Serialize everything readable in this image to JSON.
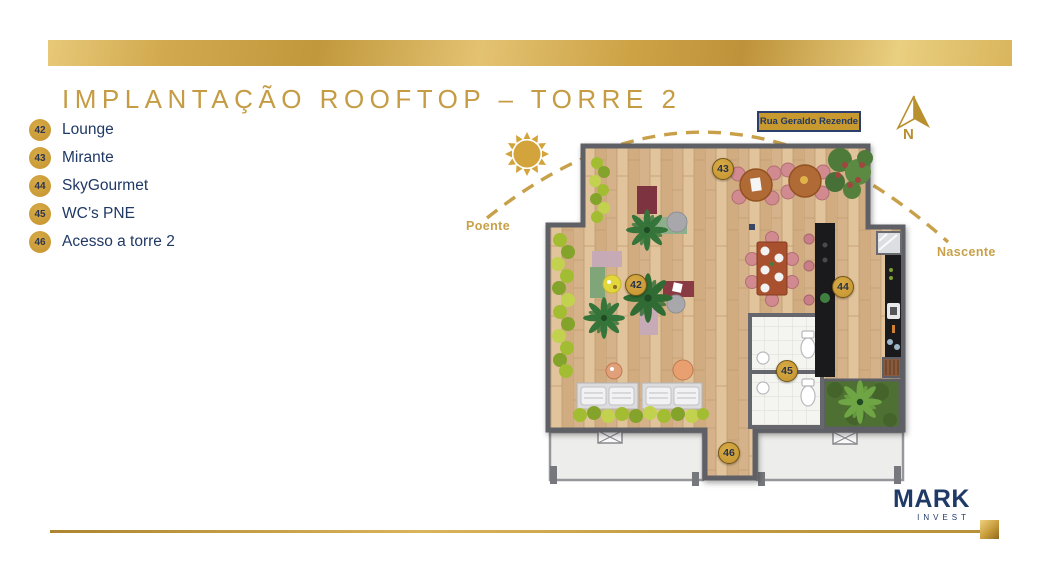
{
  "slide": {
    "title": "IMPLANTAÇÃO ROOFTOP – TORRE 2"
  },
  "colors": {
    "gold": "#C59C44",
    "navy": "#1F3864",
    "badge_gold": "#CE9F35",
    "dash_gold": "#C8A04A"
  },
  "legend": {
    "items": [
      {
        "num": "42",
        "label": "Lounge"
      },
      {
        "num": "43",
        "label": "Mirante"
      },
      {
        "num": "44",
        "label": "SkyGourmet"
      },
      {
        "num": "45",
        "label": "WC’s PNE"
      },
      {
        "num": "46",
        "label": "Acesso a torre 2"
      }
    ]
  },
  "plan": {
    "street_label": "Rua Geraldo Rezende",
    "compass_label": "N",
    "sun_west_label": "Poente",
    "sun_east_label": "Nascente",
    "markers": [
      {
        "num": "42"
      },
      {
        "num": "43"
      },
      {
        "num": "44"
      },
      {
        "num": "45"
      },
      {
        "num": "46"
      }
    ]
  },
  "logo": {
    "name": "MARK",
    "sub": "INVEST"
  }
}
